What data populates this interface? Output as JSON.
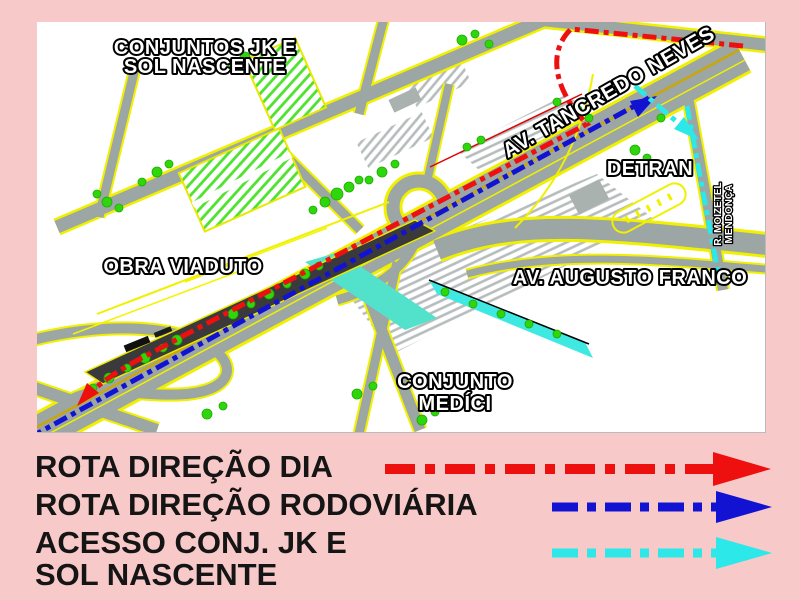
{
  "colors": {
    "background_pink": "#f8c9c9",
    "map_background": "#ffffff",
    "road_gray": "#9ca6a4",
    "road_edge_yellow": "#f0f000",
    "viaduct_dark": "#3a3a3c",
    "vegetation_green": "#2ed60c",
    "canal_cyan": "#45e5d5",
    "route_day": "#ee0f0f",
    "route_rodoviaria": "#1212d2",
    "route_acesso": "#2ce8e8"
  },
  "map_labels": {
    "conjuntos_jk_line1": "CONJUNTOS JK E",
    "conjuntos_jk_line2": "SOL NASCENTE",
    "av_tancredo_neves": "AV. TANCREDO NEVES",
    "detran": "DETRAN",
    "rua_moizetel_line1": "R. MOIZETEL",
    "rua_moizetel_line2": "MENDONÇA",
    "obra_viaduto": "OBRA VIADUTO",
    "av_augusto_franco": "AV. AUGUSTO FRANCO",
    "conjunto_medici_line1": "CONJUNTO",
    "conjunto_medici_line2": "MEDÍCI"
  },
  "legend": {
    "items": [
      {
        "label": "ROTA DIREÇÃO DIA",
        "color": "#ee0f0f"
      },
      {
        "label": "ROTA DIREÇÃO RODOVIÁRIA",
        "color": "#1212d2"
      },
      {
        "label_line1": "ACESSO CONJ. JK E",
        "label_line2": "SOL NASCENTE",
        "color": "#2ce8e8"
      }
    ]
  }
}
